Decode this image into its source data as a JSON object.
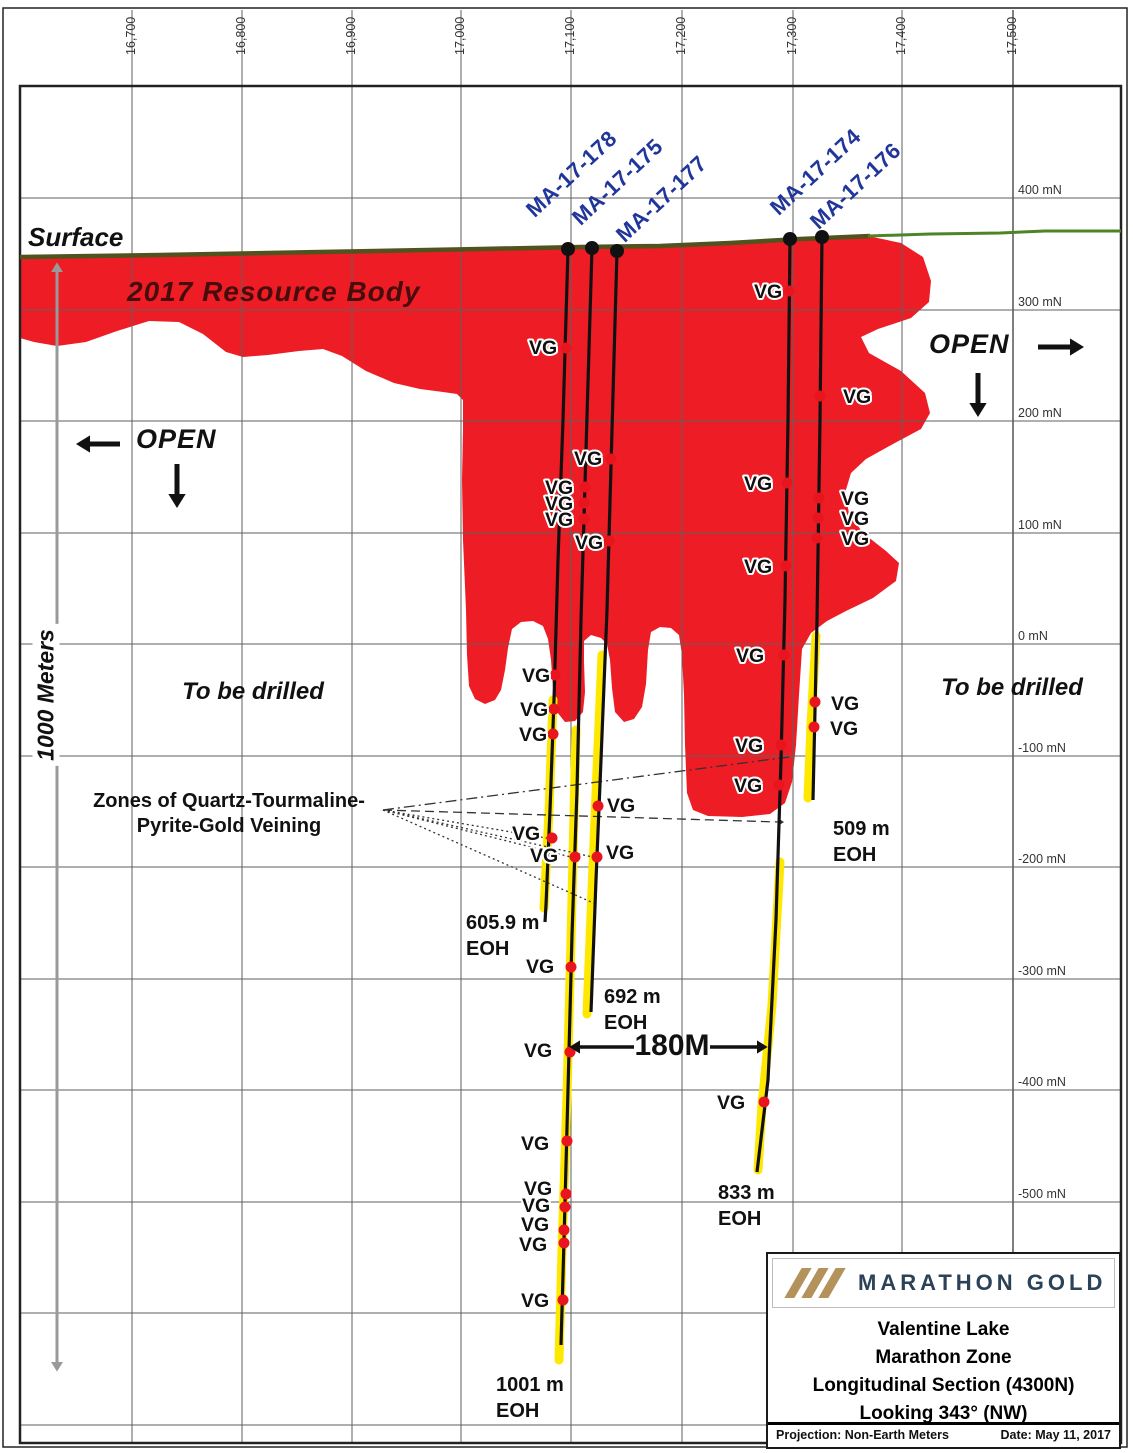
{
  "colors": {
    "resource_red": "#ee1c25",
    "trace": "#111111",
    "yellow": "#ffe800",
    "navy": "#21369b",
    "olive": "#50531e",
    "green": "#4e8428",
    "grid": "#5f5f5f",
    "frame": "#222222",
    "dot_red": "#e8141e",
    "maroon": "#470d0d",
    "brand_navy": "#2b4257",
    "brand_tan": "#b3925c",
    "gray_arrow": "#999999"
  },
  "frame": {
    "outer": [
      3,
      8,
      1127,
      1447
    ],
    "plot": {
      "left": 20,
      "top": 86,
      "right": 1121,
      "bottom": 1443
    },
    "margin_x": 1013
  },
  "grid": {
    "vx": [
      132,
      242,
      352,
      461,
      571,
      682,
      793,
      902,
      1013
    ],
    "hy": [
      198,
      310,
      421,
      533,
      644,
      756,
      867,
      979,
      1090,
      1202,
      1313,
      1425
    ]
  },
  "axis": {
    "top": [
      {
        "t": "16,700",
        "x": 132
      },
      {
        "t": "16,800",
        "x": 242
      },
      {
        "t": "16,900",
        "x": 352
      },
      {
        "t": "17,000",
        "x": 461
      },
      {
        "t": "17,100",
        "x": 571
      },
      {
        "t": "17,200",
        "x": 682
      },
      {
        "t": "17,300",
        "x": 793
      },
      {
        "t": "17,400",
        "x": 902
      },
      {
        "t": "17,500",
        "x": 1013
      }
    ],
    "right": [
      {
        "t": "400 mN",
        "y": 190
      },
      {
        "t": "300 mN",
        "y": 302
      },
      {
        "t": "200 mN",
        "y": 413
      },
      {
        "t": "100 mN",
        "y": 525
      },
      {
        "t": "0 mN",
        "y": 636
      },
      {
        "t": "-100 mN",
        "y": 748
      },
      {
        "t": "-200 mN",
        "y": 859
      },
      {
        "t": "-300 mN",
        "y": 971
      },
      {
        "t": "-400 mN",
        "y": 1082
      },
      {
        "t": "-500 mN",
        "y": 1194
      }
    ]
  },
  "labels": {
    "surface": "Surface",
    "resource_body": "2017 Resource Body",
    "open": "OPEN",
    "to_be_drilled": "To be drilled",
    "zones1": "Zones of Quartz-Tourmaline-",
    "zones2": "Pyrite-Gold Veining",
    "scale": "1000 Meters",
    "distance": "180M",
    "vg": "VG",
    "eoh": "EOH"
  },
  "drillholes": [
    {
      "name": "MA-17-178",
      "eoh": "605.9 m",
      "name_pos": [
        538,
        222
      ],
      "collar": [
        568,
        249
      ],
      "trace": [
        [
          568,
          249
        ],
        [
          563,
          420
        ],
        [
          558,
          560
        ],
        [
          554,
          700
        ],
        [
          550,
          810
        ],
        [
          546,
          905
        ],
        [
          545,
          922
        ]
      ],
      "yellow": [
        [
          553,
          700
        ],
        [
          549,
          812
        ],
        [
          544,
          908
        ]
      ],
      "eoh_pos": [
        466,
        910
      ]
    },
    {
      "name": "MA-17-175",
      "eoh": "1001 m",
      "name_pos": [
        584,
        230
      ],
      "collar": [
        592,
        248
      ],
      "trace": [
        [
          592,
          248
        ],
        [
          586,
          450
        ],
        [
          581,
          620
        ],
        [
          577,
          790
        ],
        [
          572,
          935
        ],
        [
          568,
          1090
        ],
        [
          564,
          1240
        ],
        [
          561,
          1345
        ]
      ],
      "yellow": [
        [
          576,
          730
        ],
        [
          571,
          940
        ],
        [
          567,
          1095
        ],
        [
          562,
          1250
        ],
        [
          559,
          1360
        ]
      ],
      "eoh_pos": [
        496,
        1372
      ]
    },
    {
      "name": "MA-17-177",
      "eoh": "692 m",
      "name_pos": [
        628,
        247
      ],
      "collar": [
        617,
        251
      ],
      "trace": [
        [
          617,
          251
        ],
        [
          612,
          430
        ],
        [
          607,
          610
        ],
        [
          601,
          760
        ],
        [
          596,
          880
        ],
        [
          591,
          1012
        ]
      ],
      "yellow": [
        [
          602,
          655
        ],
        [
          597,
          770
        ],
        [
          592,
          890
        ],
        [
          587,
          1014
        ]
      ],
      "eoh_pos": [
        604,
        984
      ]
    },
    {
      "name": "MA-17-174",
      "eoh": "833 m",
      "name_pos": [
        782,
        220
      ],
      "collar": [
        790,
        239
      ],
      "trace": [
        [
          790,
          239
        ],
        [
          788,
          420
        ],
        [
          785,
          600
        ],
        [
          781,
          760
        ],
        [
          776,
          920
        ],
        [
          768,
          1080
        ],
        [
          757,
          1172
        ]
      ],
      "yellow": [
        [
          780,
          862
        ],
        [
          772,
          1005
        ],
        [
          762,
          1105
        ],
        [
          758,
          1170
        ]
      ],
      "eoh_pos": [
        718,
        1180
      ]
    },
    {
      "name": "MA-17-176",
      "eoh": "509 m",
      "name_pos": [
        822,
        234
      ],
      "collar": [
        822,
        237
      ],
      "trace": [
        [
          822,
          237
        ],
        [
          820,
          420
        ],
        [
          817,
          620
        ],
        [
          813,
          800
        ]
      ],
      "yellow": [
        [
          816,
          636
        ],
        [
          811,
          725
        ],
        [
          808,
          798
        ]
      ],
      "eoh_pos": [
        833,
        816
      ]
    }
  ],
  "vg_markers": [
    {
      "lx": 529,
      "ly": 347,
      "dx": 566,
      "dy": 348
    },
    {
      "lx": 754,
      "ly": 291,
      "dx": 789,
      "dy": 291
    },
    {
      "lx": 843,
      "ly": 396,
      "dx": 820,
      "dy": 396
    },
    {
      "lx": 574,
      "ly": 458,
      "dx": 611,
      "dy": 459
    },
    {
      "lx": 545,
      "ly": 487,
      "dx": 585,
      "dy": 487
    },
    {
      "lx": 545,
      "ly": 503,
      "dx": 584,
      "dy": 503
    },
    {
      "lx": 545,
      "ly": 519,
      "dx": 584,
      "dy": 519
    },
    {
      "lx": 575,
      "ly": 542,
      "dx": 609,
      "dy": 541
    },
    {
      "lx": 744,
      "ly": 483,
      "dx": 787,
      "dy": 483
    },
    {
      "lx": 841,
      "ly": 498,
      "dx": 819,
      "dy": 498
    },
    {
      "lx": 841,
      "ly": 518,
      "dx": 818,
      "dy": 518
    },
    {
      "lx": 841,
      "ly": 538,
      "dx": 817,
      "dy": 538
    },
    {
      "lx": 744,
      "ly": 566,
      "dx": 786,
      "dy": 566
    },
    {
      "lx": 736,
      "ly": 655,
      "dx": 784,
      "dy": 655
    },
    {
      "lx": 522,
      "ly": 675,
      "dx": 555,
      "dy": 675
    },
    {
      "lx": 520,
      "ly": 709,
      "dx": 554,
      "dy": 709
    },
    {
      "lx": 519,
      "ly": 734,
      "dx": 553,
      "dy": 734
    },
    {
      "lx": 831,
      "ly": 703,
      "dx": 815,
      "dy": 702
    },
    {
      "lx": 830,
      "ly": 728,
      "dx": 814,
      "dy": 727
    },
    {
      "lx": 735,
      "ly": 745,
      "dx": 781,
      "dy": 745
    },
    {
      "lx": 734,
      "ly": 785,
      "dx": 779,
      "dy": 785
    },
    {
      "lx": 607,
      "ly": 805,
      "dx": 598,
      "dy": 806
    },
    {
      "lx": 512,
      "ly": 833,
      "dx": 552,
      "dy": 838
    },
    {
      "lx": 530,
      "ly": 855,
      "dx": 575,
      "dy": 857
    },
    {
      "lx": 606,
      "ly": 852,
      "dx": 597,
      "dy": 857
    },
    {
      "lx": 526,
      "ly": 966,
      "dx": 571,
      "dy": 967
    },
    {
      "lx": 524,
      "ly": 1050,
      "dx": 570,
      "dy": 1052
    },
    {
      "lx": 717,
      "ly": 1102,
      "dx": 764,
      "dy": 1102
    },
    {
      "lx": 521,
      "ly": 1143,
      "dx": 567,
      "dy": 1141
    },
    {
      "lx": 524,
      "ly": 1188,
      "dx": 566,
      "dy": 1194
    },
    {
      "lx": 522,
      "ly": 1205,
      "dx": 565,
      "dy": 1207
    },
    {
      "lx": 521,
      "ly": 1224,
      "dx": 564,
      "dy": 1230
    },
    {
      "lx": 519,
      "ly": 1244,
      "dx": 564,
      "dy": 1243
    },
    {
      "lx": 521,
      "ly": 1300,
      "dx": 563,
      "dy": 1300
    }
  ],
  "shapes": {
    "resource_body": "M 20 258 L 130 254 L 300 252 L 430 250 L 560 247 L 660 245 L 760 241 L 868 236 L 901 243 L 923 257 L 931 281 L 929 302 L 911 318 L 878 329 L 861 337 L 869 353 L 901 371 L 925 393 L 930 413 L 921 429 L 893 444 L 866 459 L 851 473 L 845 493 L 849 513 L 863 533 L 886 551 L 899 563 L 896 581 L 873 598 L 846 611 L 827 621 L 811 633 L 802 649 L 799 695 L 796 745 L 792 782 L 785 803 L 770 814 L 742 817 L 708 816 L 693 810 L 687 793 L 685 745 L 684 695 L 682 655 L 679 635 L 671 628 L 660 627 L 651 632 L 648 650 L 646 684 L 642 707 L 634 719 L 624 722 L 615 712 L 612 688 L 610 660 L 607 644 L 601 638 L 591 635 L 584 641 L 584 662 L 585 692 L 583 712 L 575 721 L 565 722 L 557 712 L 553 688 L 551 660 L 548 639 L 543 626 L 533 621 L 521 622 L 512 629 L 508 648 L 505 670 L 501 690 L 495 700 L 485 704 L 475 699 L 469 686 L 467 655 L 466 610 L 463 540 L 462 480 L 463 430 L 463 400 L 457 394 L 443 392 L 420 389 L 394 383 L 366 371 L 342 356 L 323 349 L 299 351 L 268 355 L 243 357 L 226 352 L 203 334 L 179 322 L 149 321 L 117 331 L 86 342 L 57 346 L 34 342 L 20 338 Z",
    "surface_olive": [
      [
        20,
        257
      ],
      [
        160,
        255
      ],
      [
        320,
        252
      ],
      [
        480,
        249
      ],
      [
        580,
        247
      ],
      [
        660,
        246
      ],
      [
        730,
        243
      ],
      [
        800,
        239
      ],
      [
        870,
        236
      ]
    ],
    "surface_green": [
      [
        868,
        236
      ],
      [
        930,
        234
      ],
      [
        1000,
        233
      ],
      [
        1045,
        231
      ],
      [
        1121,
        231
      ]
    ]
  },
  "fan": {
    "origin": [
      383,
      810
    ],
    "lines": [
      {
        "to": [
          789,
          757
        ],
        "dash": "11 4 2 4"
      },
      {
        "to": [
          779,
          822
        ],
        "dash": "9 5",
        "arrow": true
      },
      {
        "to": [
          552,
          839
        ],
        "dash": "2 3"
      },
      {
        "to": [
          575,
          858
        ],
        "dash": "2 3"
      },
      {
        "to": [
          597,
          858
        ],
        "dash": "2 3"
      },
      {
        "to": [
          598,
          905
        ],
        "dash": "2 3"
      }
    ]
  },
  "arrows": [
    {
      "name": "open-left-arrow",
      "x1": 120,
      "y1": 444,
      "x2": 90,
      "y2": 444,
      "w": 5
    },
    {
      "name": "open-left-down-arrow",
      "x1": 177,
      "y1": 464,
      "x2": 177,
      "y2": 494,
      "w": 5
    },
    {
      "name": "open-right-arrow",
      "x1": 1038,
      "y1": 347,
      "x2": 1070,
      "y2": 347,
      "w": 5
    },
    {
      "name": "open-right-down-arrow",
      "x1": 978,
      "y1": 373,
      "x2": 978,
      "y2": 403,
      "w": 5
    },
    {
      "name": "distance-left-arrow",
      "x1": 634,
      "y1": 1047,
      "x2": 580,
      "y2": 1047,
      "w": 3.5
    },
    {
      "name": "distance-right-arrow",
      "x1": 710,
      "y1": 1047,
      "x2": 757,
      "y2": 1047,
      "w": 3.5
    },
    {
      "name": "scale-arrow",
      "x1": 57,
      "y1": 272,
      "x2": 57,
      "y2": 1362,
      "w": 3,
      "color": "#999999",
      "both": true
    }
  ],
  "title_block": {
    "brand": "MARATHON GOLD",
    "line1": "Valentine Lake",
    "line2": "Marathon Zone",
    "line3": "Longitudinal Section (4300N)",
    "line4": "Looking 343° (NW)",
    "projection": "Projection: Non-Earth Meters",
    "date": "Date: May 11, 2017"
  }
}
